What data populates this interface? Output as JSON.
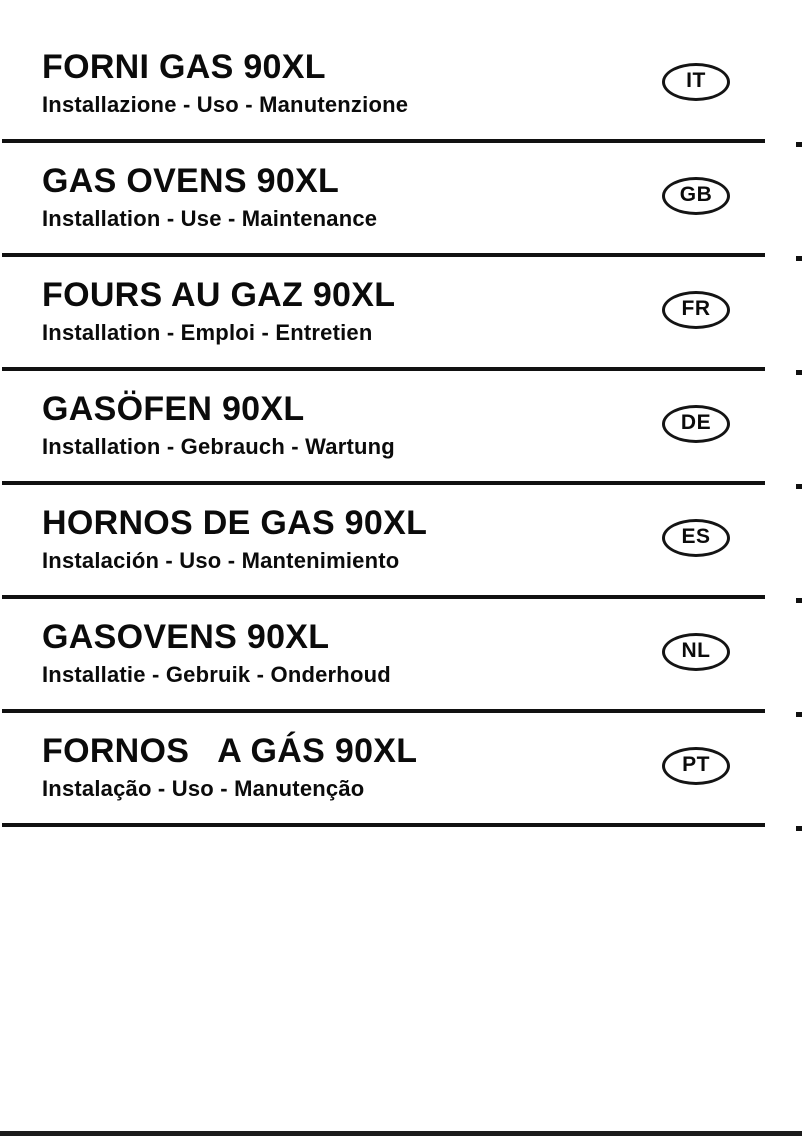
{
  "document": {
    "kind": "multilingual-manual-cover"
  },
  "sections": [
    {
      "badge": "IT",
      "title": "FORNI GAS 90XL",
      "subtitle": "Installazione - Uso - Manutenzione"
    },
    {
      "badge": "GB",
      "title": "GAS OVENS 90XL",
      "subtitle": "Installation - Use - Maintenance"
    },
    {
      "badge": "FR",
      "title": "FOURS AU GAZ 90XL",
      "subtitle": "Installation - Emploi - Entretien"
    },
    {
      "badge": "DE",
      "title": "GASÖFEN 90XL",
      "subtitle": "Installation - Gebrauch - Wartung"
    },
    {
      "badge": "ES",
      "title": "HORNOS DE GAS 90XL",
      "subtitle": "Instalación - Uso - Mantenimiento"
    },
    {
      "badge": "NL",
      "title": "GASOVENS 90XL",
      "subtitle": "Installatie - Gebruik - Onderhoud"
    },
    {
      "badge": "PT",
      "title": "FORNOS   A GÁS 90XL",
      "subtitle": "Instalação - Uso - Manutenção"
    }
  ],
  "colors": {
    "text": "#0b0b0b",
    "divider": "#111111",
    "badge_border": "#141414",
    "background": "#ffffff"
  }
}
